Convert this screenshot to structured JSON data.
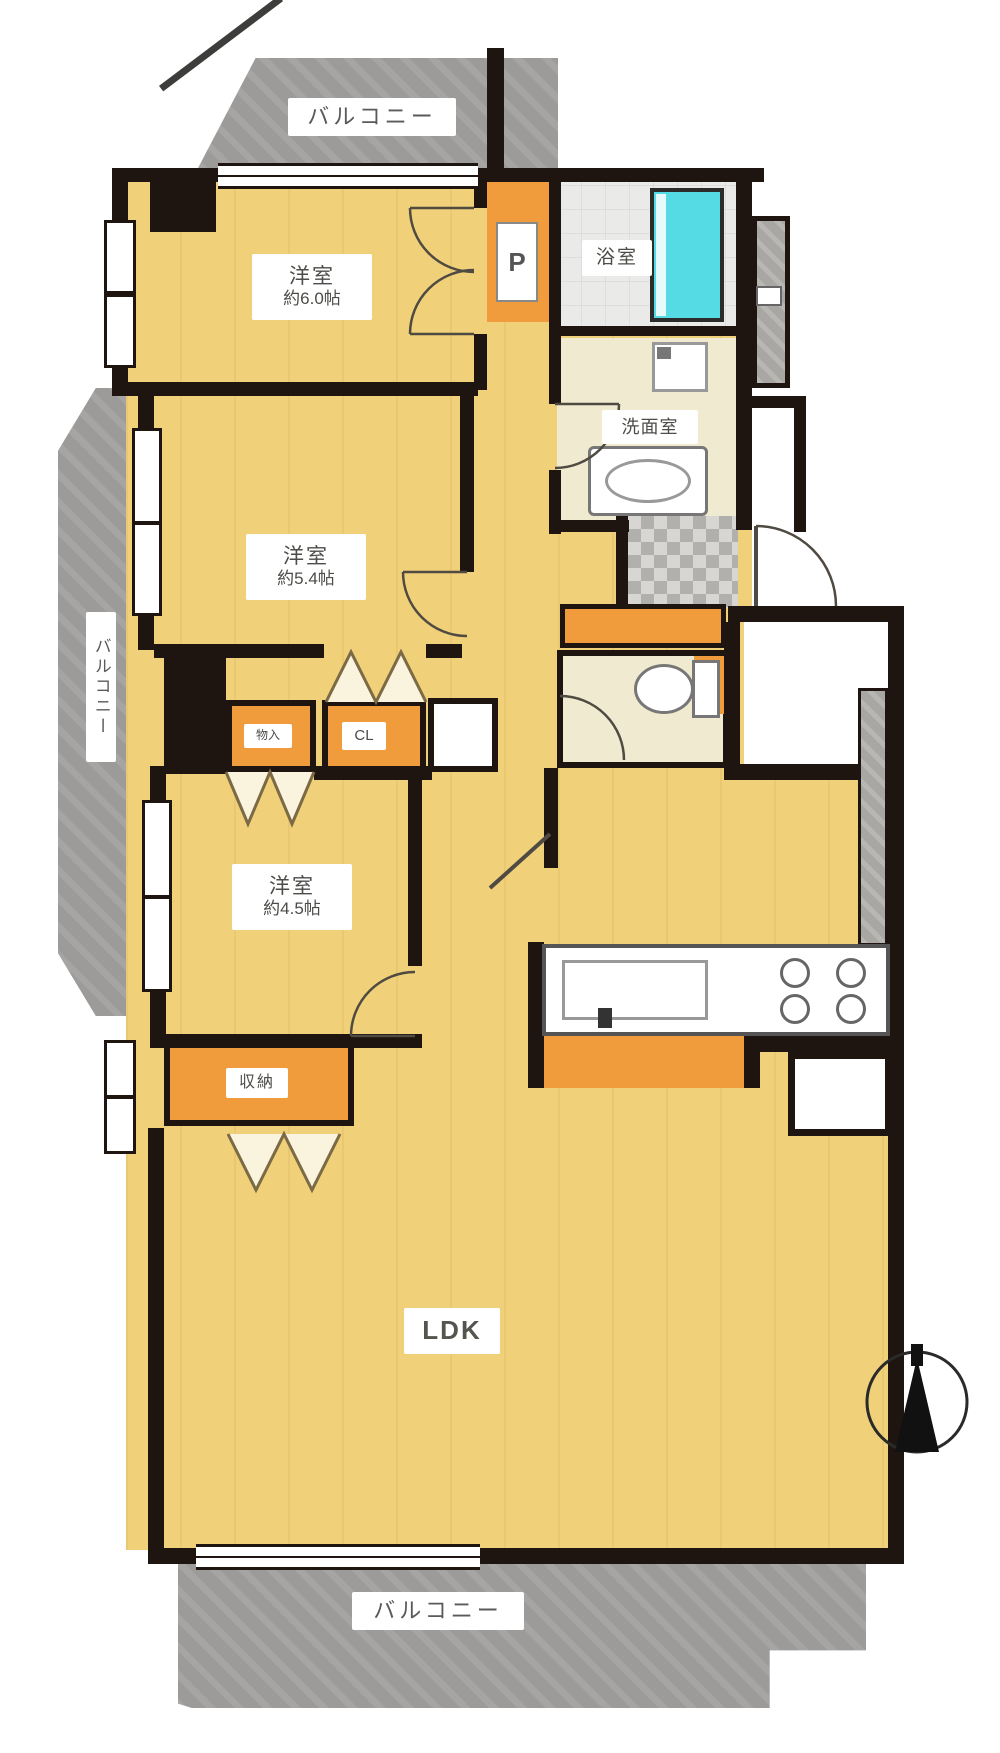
{
  "plan": {
    "balconies": {
      "top": "バルコニー",
      "left": "バルコニー",
      "bottom": "バルコニー"
    },
    "rooms": [
      {
        "name": "洋室",
        "size": "約6.0帖"
      },
      {
        "name": "洋室",
        "size": "約5.4帖"
      },
      {
        "name": "洋室",
        "size": "約4.5帖"
      }
    ],
    "bathroom": "浴室",
    "washroom": "洗面室",
    "closet": "CL",
    "small_closet": "物入",
    "storage": "収納",
    "living_dining_kitchen": "LDK",
    "pillar_mark": "P"
  },
  "icons": {
    "compass": "north-arrow-icon"
  },
  "colors": {
    "floor_yellow": "#f0d078",
    "closet_orange": "#f09c3c",
    "wet_area_cream": "#f0ead0",
    "bathroom_gray": "#eaeae8",
    "bathtub_cyan": "#55dbe3",
    "balcony_gray": "#9d9b99",
    "wall_black": "#1e1410"
  }
}
